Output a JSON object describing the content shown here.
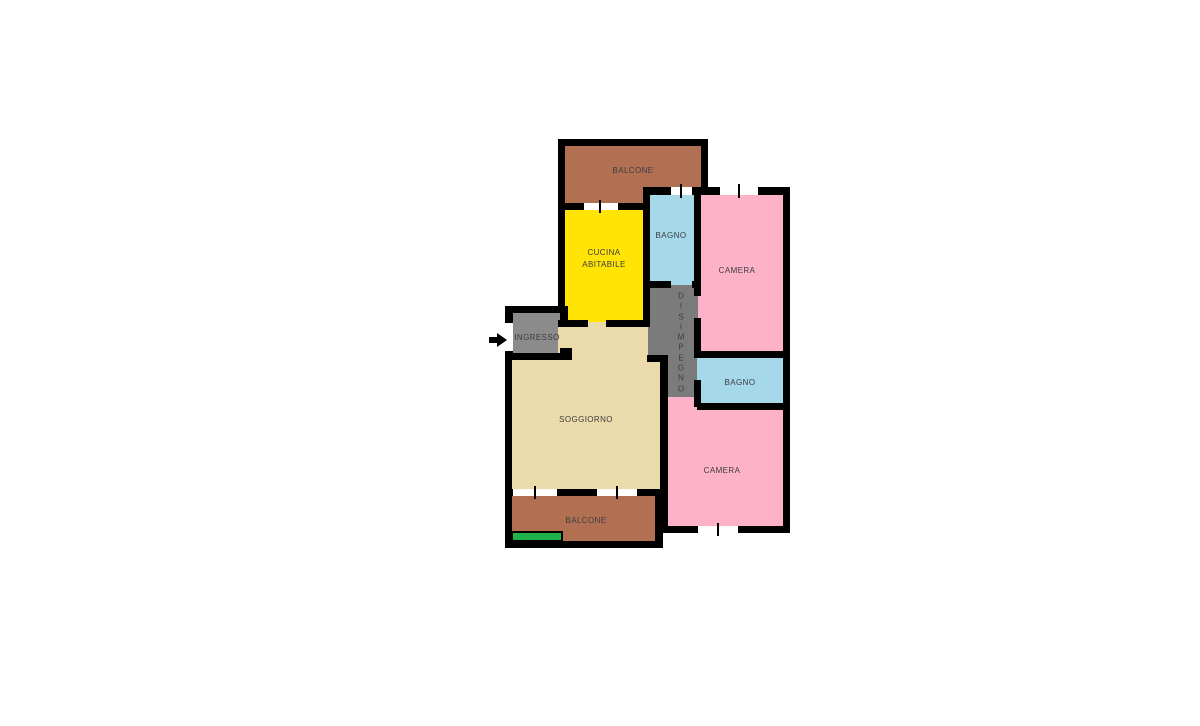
{
  "canvas": {
    "width": 1200,
    "height": 726,
    "background": "#ffffff"
  },
  "palette": {
    "wall": "#000000",
    "balcony_brown": "#b27052",
    "kitchen_yellow": "#ffe405",
    "bath_cyan": "#a5d9ea",
    "bedroom_pink": "#fdb2c7",
    "hall_gray": "#7b7b7b",
    "entry_gray": "#8b8b8b",
    "living_beige": "#ecdbaa",
    "mat_green": "#21b14b",
    "label_text": "#3b3b42"
  },
  "floorplan": {
    "rooms": [
      {
        "id": "balcone-top",
        "label": "BALCONE",
        "color": "#b27052",
        "rects": [
          [
            563,
            144,
            142,
            63
          ]
        ],
        "label_pos": [
          633,
          171
        ]
      },
      {
        "id": "cucina",
        "label": "CUCINA\nABITABILE",
        "color": "#ffe405",
        "rects": [
          [
            563,
            205,
            84,
            119
          ]
        ],
        "label_pos": [
          604,
          259
        ]
      },
      {
        "id": "bagno-top",
        "label": "BAGNO",
        "color": "#a5d9ea",
        "rects": [
          [
            647,
            193,
            51,
            92
          ]
        ],
        "label_pos": [
          671,
          236
        ]
      },
      {
        "id": "camera-top",
        "label": "CAMERA",
        "color": "#fdb2c7",
        "rects": [
          [
            698,
            193,
            88,
            161
          ]
        ],
        "label_pos": [
          737,
          271
        ]
      },
      {
        "id": "ingresso",
        "label": "INGRESSO",
        "color": "#8b8b8b",
        "rects": [
          [
            509,
            310,
            53,
            46
          ]
        ],
        "label_pos": [
          537,
          338
        ]
      },
      {
        "id": "soggiorno",
        "label": "SOGGIORNO",
        "color": "#ecdbaa",
        "rects": [
          [
            558,
            322,
            90,
            40
          ],
          [
            509,
            356,
            155,
            137
          ]
        ],
        "label_pos": [
          586,
          420
        ]
      },
      {
        "id": "disimpegno",
        "label": "DISIMPEGNO",
        "color": "#7b7b7b",
        "rects": [
          [
            648,
            285,
            50,
            73
          ],
          [
            664,
            355,
            34,
            45
          ]
        ],
        "label_pos": [
          681,
          343
        ],
        "vertical": true
      },
      {
        "id": "camera-bottom",
        "label": "CAMERA",
        "color": "#fdb2c7",
        "rects": [
          [
            664,
            397,
            122,
            132
          ]
        ],
        "label_pos": [
          722,
          471
        ]
      },
      {
        "id": "bagno-bottom",
        "label": "BAGNO",
        "color": "#a5d9ea",
        "rects": [
          [
            697,
            355,
            89,
            48
          ]
        ],
        "label_pos": [
          740,
          383
        ]
      },
      {
        "id": "balcone-bottom",
        "label": "BALCONE",
        "color": "#b27052",
        "rects": [
          [
            509,
            493,
            150,
            50
          ]
        ],
        "label_pos": [
          586,
          521
        ]
      }
    ],
    "walls": [
      [
        558,
        139,
        150,
        7
      ],
      [
        558,
        139,
        7,
        174
      ],
      [
        701,
        139,
        7,
        56
      ],
      [
        558,
        203,
        92,
        7
      ],
      [
        643,
        187,
        147,
        8
      ],
      [
        783,
        187,
        7,
        346
      ],
      [
        660,
        526,
        130,
        7
      ],
      [
        655,
        489,
        8,
        59
      ],
      [
        505,
        541,
        158,
        7
      ],
      [
        505,
        489,
        7,
        59
      ],
      [
        505,
        353,
        7,
        143
      ],
      [
        505,
        489,
        158,
        7
      ],
      [
        505,
        306,
        8,
        54
      ],
      [
        505,
        306,
        63,
        7
      ],
      [
        560,
        306,
        8,
        20
      ],
      [
        505,
        353,
        66,
        7
      ],
      [
        560,
        348,
        12,
        12
      ],
      [
        558,
        320,
        30,
        7
      ],
      [
        606,
        320,
        44,
        7
      ],
      [
        643,
        187,
        7,
        140
      ],
      [
        647,
        355,
        20,
        7
      ],
      [
        694,
        187,
        7,
        109
      ],
      [
        694,
        318,
        7,
        40
      ],
      [
        694,
        380,
        7,
        27
      ],
      [
        643,
        281,
        28,
        7
      ],
      [
        692,
        281,
        9,
        7
      ],
      [
        694,
        351,
        89,
        7
      ],
      [
        697,
        403,
        86,
        7
      ],
      [
        660,
        355,
        8,
        178
      ]
    ],
    "windows": [
      {
        "rect": [
          584,
          203,
          34,
          7
        ],
        "tick": [
          599,
          200,
          2,
          13
        ]
      },
      {
        "rect": [
          671,
          187,
          21,
          8
        ],
        "tick": [
          680,
          184,
          2,
          14
        ]
      },
      {
        "rect": [
          720,
          187,
          38,
          8
        ],
        "tick": [
          738,
          184,
          2,
          14
        ]
      },
      {
        "rect": [
          698,
          526,
          40,
          7
        ],
        "tick": [
          717,
          523,
          2,
          13
        ]
      },
      {
        "rect": [
          513,
          489,
          44,
          7
        ],
        "tick": [
          534,
          486,
          2,
          13
        ]
      },
      {
        "rect": [
          597,
          489,
          40,
          7
        ],
        "tick": [
          616,
          486,
          2,
          13
        ]
      }
    ],
    "entry_door_gap": {
      "rect": [
        505,
        323,
        8,
        28
      ]
    },
    "green_mat": {
      "rect": [
        511,
        531,
        52,
        11
      ],
      "color": "#21b14b"
    },
    "entry_arrow": {
      "stem": [
        489,
        337,
        9,
        6
      ],
      "head_left": 497,
      "head_top": 333
    }
  }
}
